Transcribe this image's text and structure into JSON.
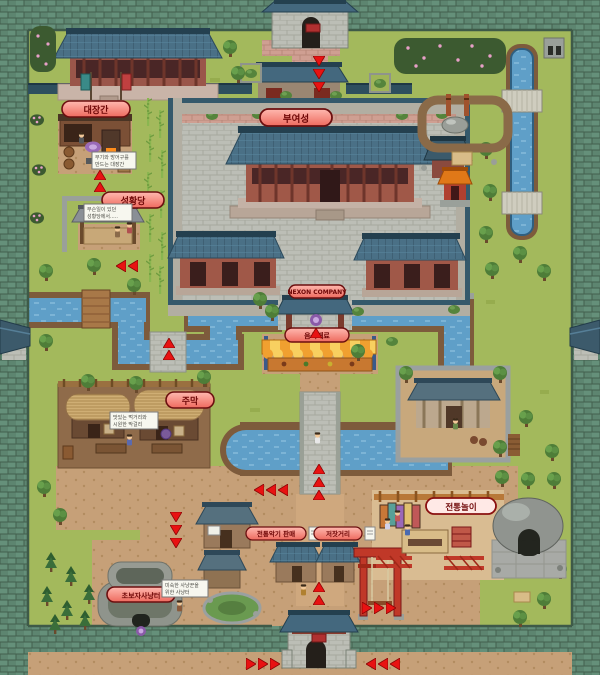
{
  "meta": {
    "map_width": 600,
    "map_height": 675,
    "kind": "pixel-art castle town map"
  },
  "palette": {
    "grass": "#a3b95c",
    "dirt": "#c6a078",
    "dark_dirt": "#8f6b4a",
    "water": "#5f9fc8",
    "wall_green": "#5d8570",
    "roof_blue": "#4a7086",
    "arrow": "#e81212",
    "label_bg": "#f4928a",
    "label_border": "#6b0f0f",
    "label_text": "#6e0606"
  },
  "labels": {
    "blacksmith": "대장간",
    "castle": "부여성",
    "shrine": "성황당",
    "nexon_banner": "NEXON COMPANY",
    "food_stall": "음식재료",
    "tavern": "주막",
    "traditional_games": "전통놀이",
    "hunting_ground": "초보자사냥터",
    "shop_left": "전통악기 판매",
    "shop_right": "저잣거리"
  },
  "signs": {
    "blacksmith": {
      "line1": "무기와 방어구를",
      "line2": "만드는 대장간"
    },
    "shrine": {
      "line1": "무슨일이 있던",
      "line2": "성황당에서....."
    },
    "tavern": {
      "line1": "맛있는 먹거리와",
      "line2": "시원한 막걸리"
    },
    "hunting": {
      "line1": "미숙한 사냥꾼을",
      "line2": "위한 사냥터"
    }
  }
}
